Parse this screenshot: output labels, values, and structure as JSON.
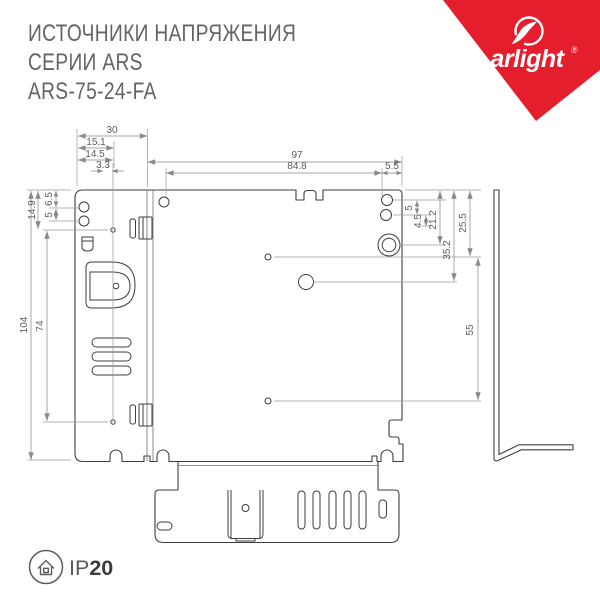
{
  "header": {
    "line1": "ИСТОЧНИКИ НАПРЯЖЕНИЯ",
    "line2": "СЕРИИ ARS",
    "line3": "ARS-75-24-FA"
  },
  "brand": {
    "name": "arlight",
    "registered": "®"
  },
  "dims": {
    "d30": "30",
    "d15_1": "15.1",
    "d14_5": "14.5",
    "d3_3": "3.3",
    "d97": "97",
    "d84_8": "84.8",
    "d5_5": "5.5",
    "d14_9": "14.9",
    "d6_5": "6.5",
    "d5_left": "5",
    "d104": "104",
    "d74": "74",
    "d5_right": "5",
    "d4_5": "4.5",
    "d21_2": "21.2",
    "d35_2": "35.2",
    "d25_5": "25.5",
    "d55": "55"
  },
  "footer": {
    "ip_prefix": "IP",
    "ip_rating": "20"
  },
  "colors": {
    "accent": "#e41e2d",
    "line": "#3e3e3e",
    "dim": "#8a8a8a",
    "label": "#5c5c5c",
    "title": "#646464"
  }
}
